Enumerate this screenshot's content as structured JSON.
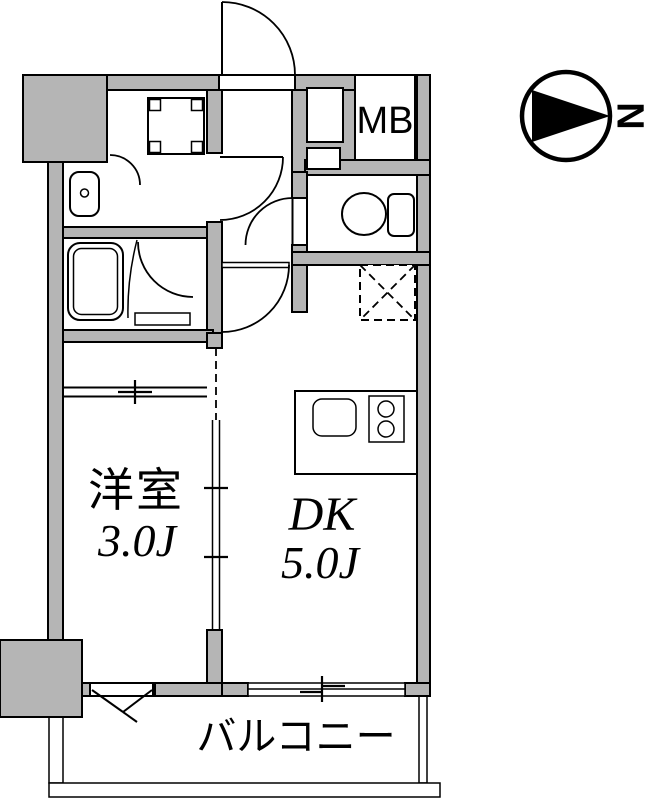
{
  "colors": {
    "wall_fill": "#b5b5b5",
    "line": "#000000",
    "background": "#ffffff"
  },
  "compass": {
    "north_label": "N"
  },
  "rooms": {
    "western_room": {
      "label": "洋室",
      "size": "3.0J"
    },
    "dining_kitchen": {
      "label": "DK",
      "size": "5.0J"
    },
    "balcony": {
      "label": "バルコニー"
    },
    "meter_box": {
      "label": "MB"
    }
  }
}
